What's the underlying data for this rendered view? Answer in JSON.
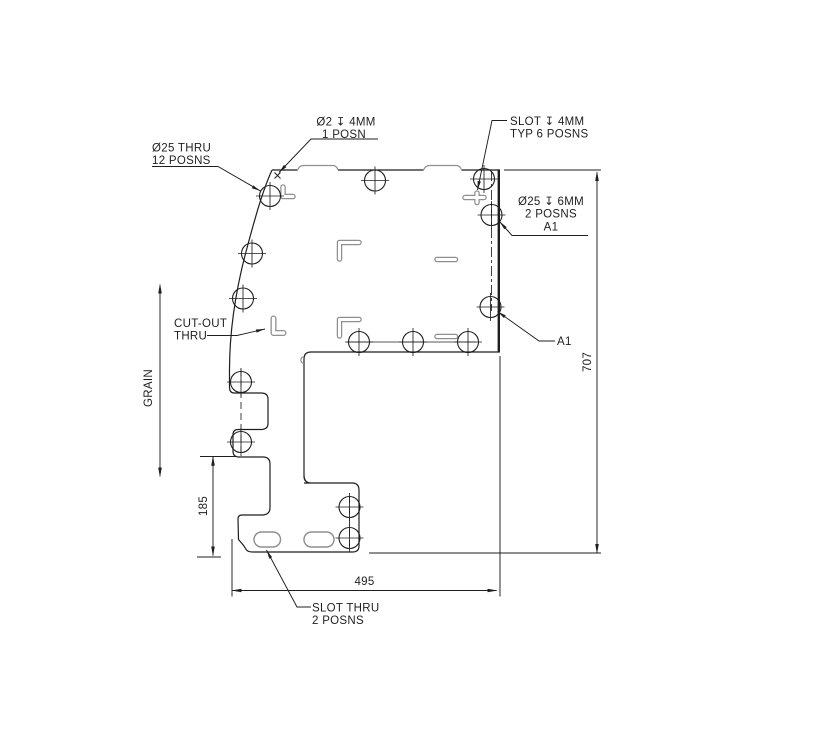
{
  "title": "sheet-part-engineering-drawing",
  "colors": {
    "line": "#1f1f1f",
    "feature": "#8f8f8f",
    "background": "#ffffff"
  },
  "labels": {
    "dia2_l1": "Ø2 ↧ 4MM",
    "dia2_l2": "1 POSN",
    "dia25thru_l1": "Ø25 THRU",
    "dia25thru_l2": "12 POSNS",
    "slot_l1": "SLOT ↧ 4MM",
    "slot_l2": "TYP 6 POSNS",
    "dia25cb_l1": "Ø25 ↧ 6MM",
    "dia25cb_l2": "2 POSNS",
    "dia25cb_l3": "A1",
    "a1_ref": "A1",
    "cutout_l1": "CUT-OUT",
    "cutout_l2": "THRU",
    "slotthru_l1": "SLOT THRU",
    "slotthru_l2": "2 POSNS",
    "grain": "GRAIN",
    "dim_185": "185",
    "dim_495": "495",
    "dim_707": "707"
  }
}
